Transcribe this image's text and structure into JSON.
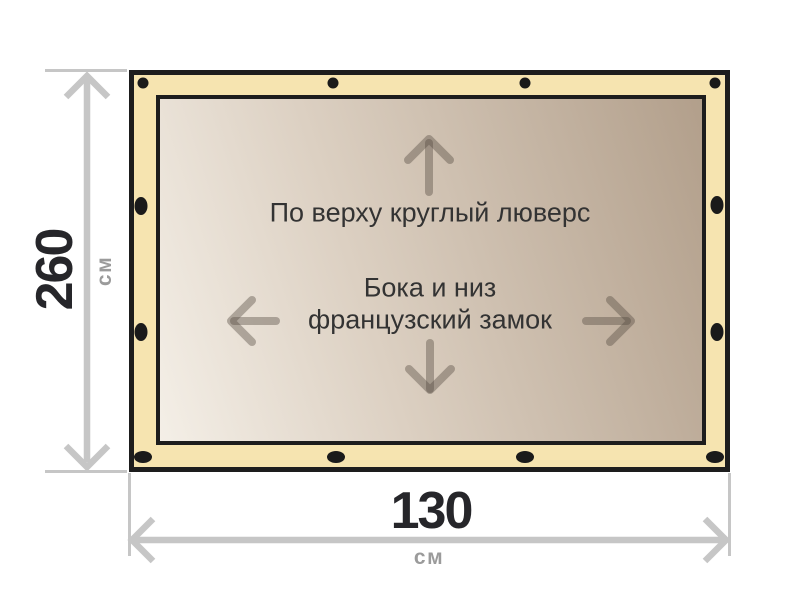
{
  "product_diagram": {
    "surface_labels": {
      "top_edge_note": "По верху круглый люверс",
      "sides_note_line1": "Бока и низ",
      "sides_note_line2": "французский замок"
    },
    "dimensions": {
      "height": {
        "value": "260",
        "unit": "см"
      },
      "width": {
        "value": "130",
        "unit": "см"
      }
    },
    "icons": {
      "surface_arrows": [
        "up-arrow",
        "down-arrow",
        "left-arrow",
        "right-arrow"
      ],
      "grommets_count": 12
    },
    "colors": {
      "frame_fill": "#f6e4b0",
      "frame_border": "#1d1d1d",
      "surface_gradient_light": "#f4efe7",
      "surface_gradient_dark": "#b29f8b",
      "grommet": "#1a1a1a",
      "dimension_line": "#c6c6c6",
      "dimension_value_text": "#26262a",
      "dimension_unit_text": "#9b9b9b",
      "annotation_text": "#333333",
      "surface_arrow": "#9a9086"
    }
  }
}
